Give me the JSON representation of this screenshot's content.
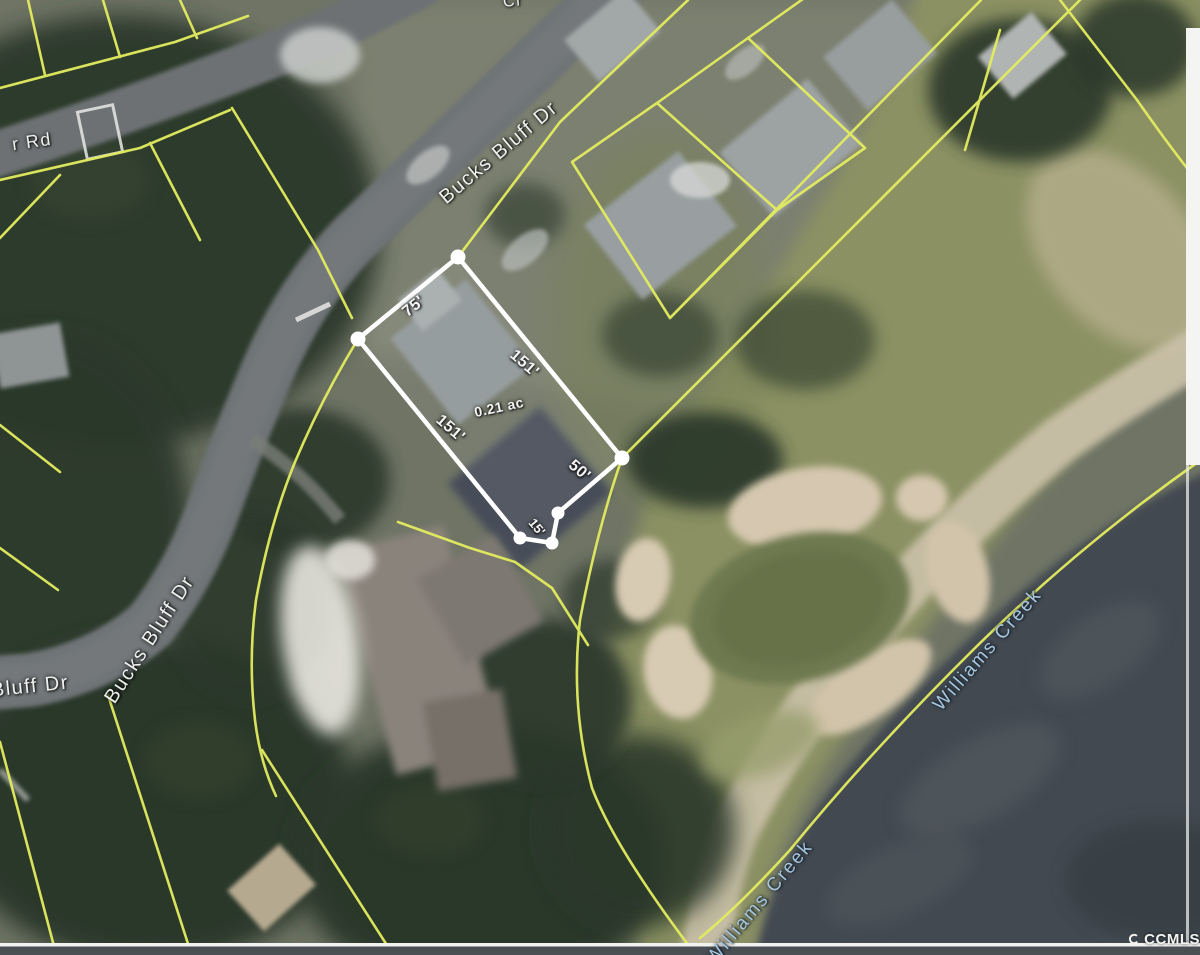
{
  "streets": {
    "bucks_bluff_top": "Bucks Bluff Dr",
    "bucks_bluff_curve": "Bucks Bluff Dr",
    "bluff_dr_partial": "Bluff Dr",
    "rd_partial": "r Rd",
    "top_edge_partial": "Cr"
  },
  "parcel": {
    "frontage": "75'",
    "side_northeast": "151'",
    "side_southwest": "151'",
    "rear": "50'",
    "rear_jog": "15'",
    "area": "0.21 ac",
    "outline_color": "#ffffff"
  },
  "water": {
    "creek_label_upper": "Williams Creek",
    "creek_label_lower": "Williams Creek",
    "label_color": "#a6c6de"
  },
  "watermark": {
    "text": "CCMLS"
  },
  "colors": {
    "parcel_lines": "#e3ec5f",
    "water": "#434a51",
    "fairway": "#8b9164",
    "sand": "#d2c4ab",
    "trees": "#2c372b",
    "road": "#6e7376"
  }
}
